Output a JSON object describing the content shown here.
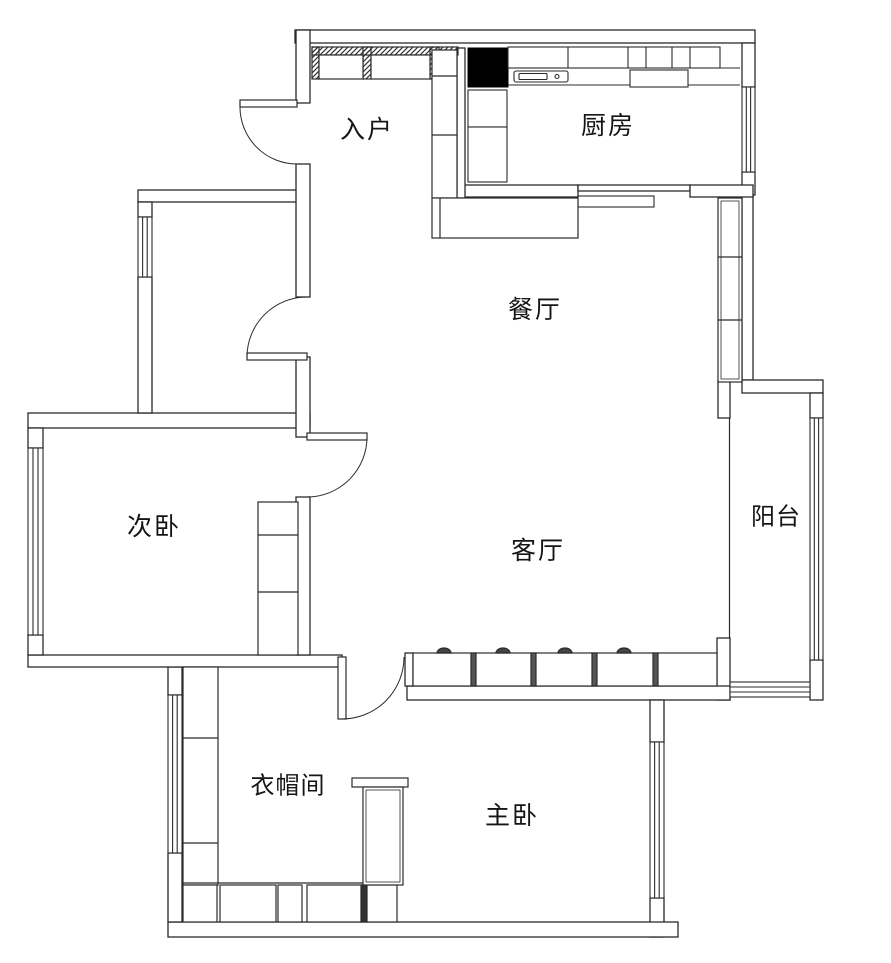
{
  "rooms": {
    "entry": {
      "label": "入户"
    },
    "kitchen": {
      "label": "厨房"
    },
    "dining": {
      "label": "餐厅"
    },
    "living": {
      "label": "客厅"
    },
    "second_bedroom": {
      "label": "次卧"
    },
    "balcony": {
      "label": "阳台"
    },
    "cloakroom": {
      "label": "衣帽间"
    },
    "master_bedroom": {
      "label": "主卧"
    }
  },
  "colors": {
    "line": "#2b2b2b",
    "column_fill": "#000000",
    "background": "#ffffff"
  }
}
